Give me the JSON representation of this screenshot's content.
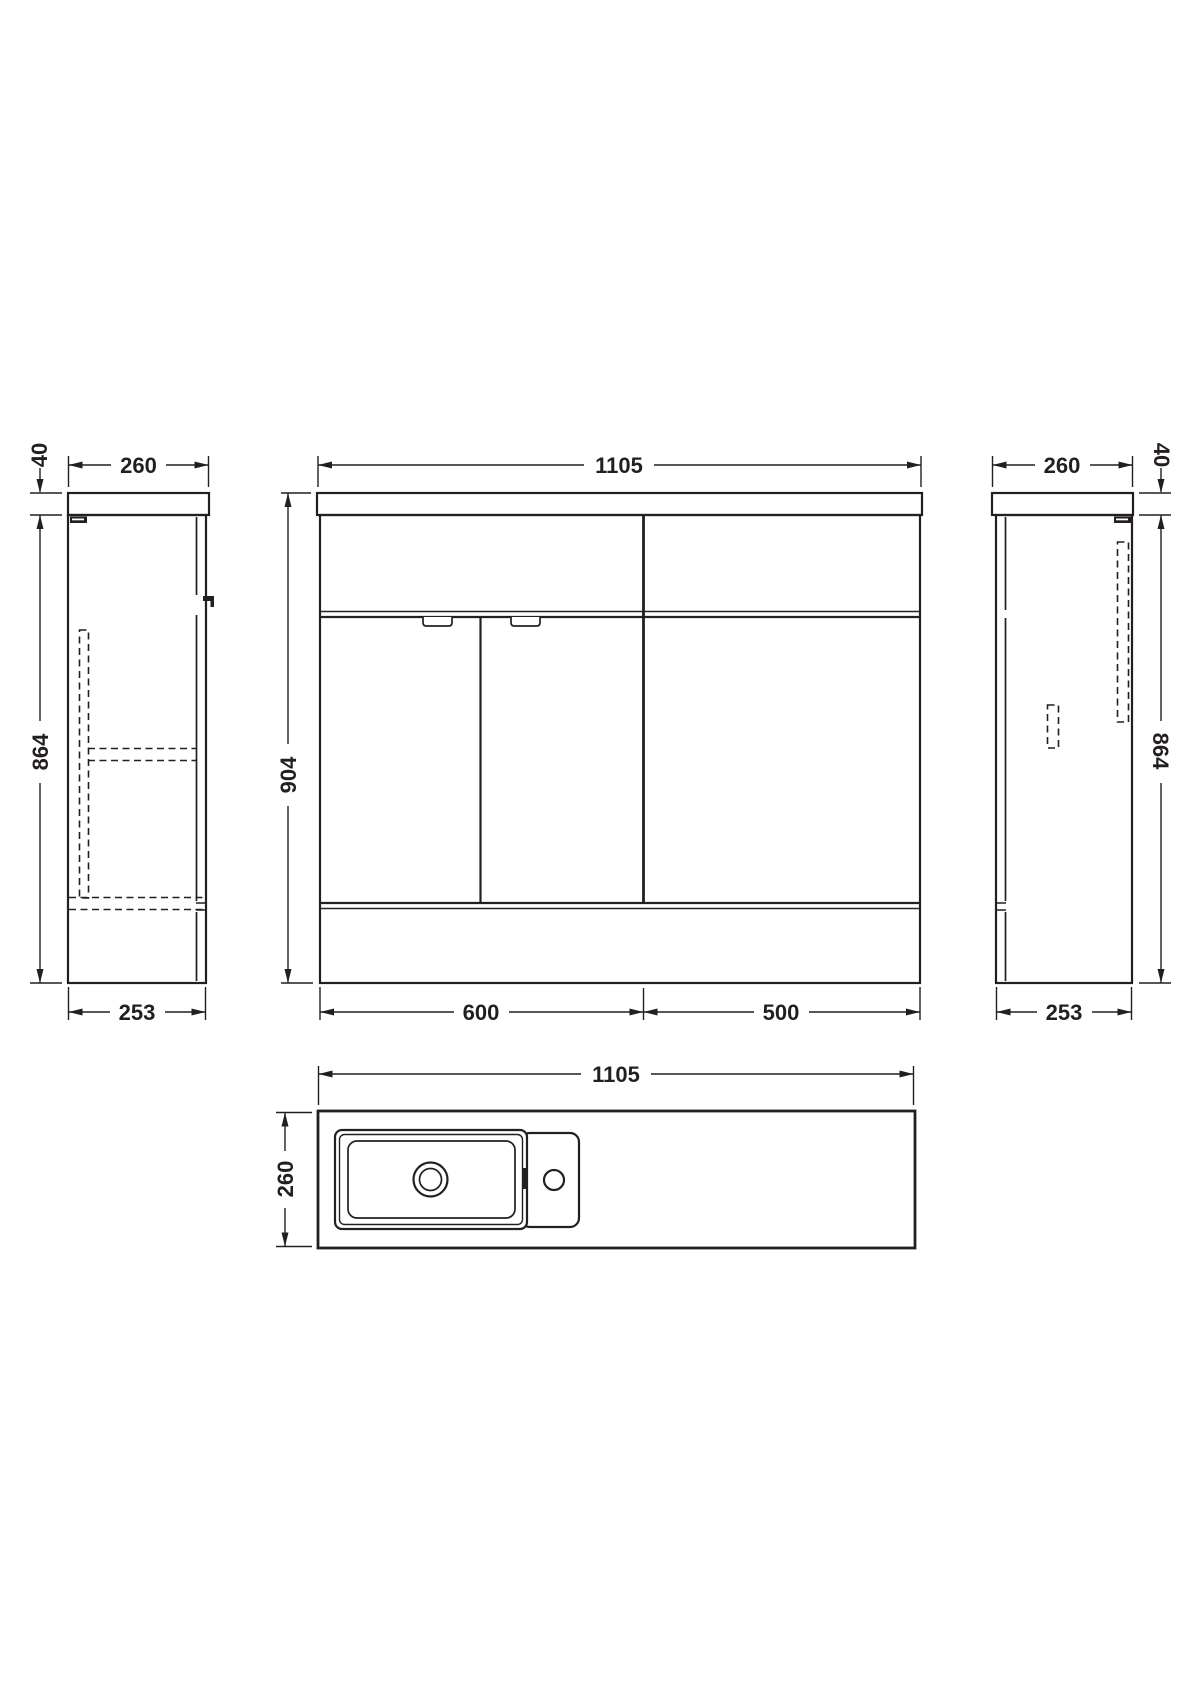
{
  "drawing": {
    "type": "technical-dimension-drawing",
    "subject": "combination vanity and WC furniture unit",
    "background_color": "#ffffff",
    "line_color": "#231f20"
  },
  "dimensions": {
    "left_view": {
      "worktop_thickness": "40",
      "worktop_depth": "260",
      "cabinet_height": "864",
      "cabinet_depth": "253"
    },
    "front_view": {
      "total_width": "1105",
      "total_height": "904",
      "vanity_section_width": "600",
      "wc_section_width": "500"
    },
    "right_view": {
      "worktop_depth": "260",
      "worktop_thickness": "40",
      "cabinet_height": "864",
      "cabinet_depth": "253"
    },
    "plan_view": {
      "total_width": "1105",
      "worktop_depth": "260"
    }
  }
}
